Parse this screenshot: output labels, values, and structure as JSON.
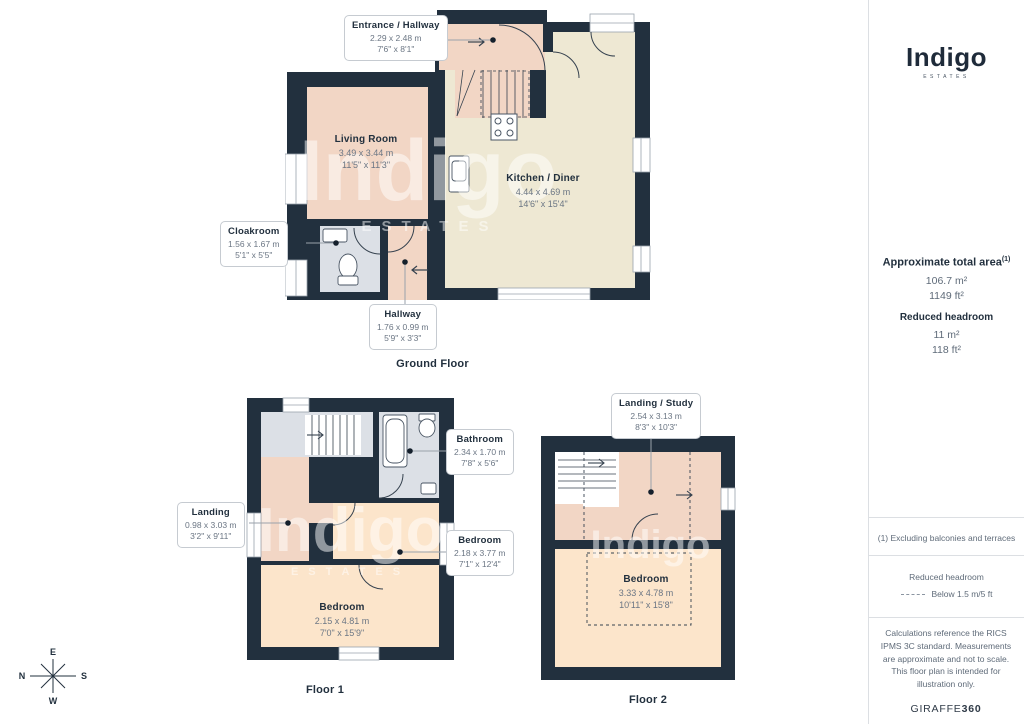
{
  "branding": {
    "logo": "Indigo",
    "logo_sub": "ESTATES",
    "giraffe_prefix": "GIRAFFE",
    "giraffe_suffix": "360"
  },
  "watermark": {
    "text": "Indigo",
    "sub": "ESTATES"
  },
  "sidebar": {
    "total_area": {
      "label": "Approximate total area",
      "sup": "(1)",
      "metric": "106.7 m²",
      "imperial": "1149 ft²"
    },
    "reduced_headroom": {
      "label": "Reduced headroom",
      "metric": "11 m²",
      "imperial": "118 ft²"
    },
    "footnote": "(1) Excluding balconies and terraces",
    "legend": {
      "label": "Reduced headroom",
      "value": "Below 1.5 m/5 ft"
    },
    "disclaimer": "Calculations reference the RICS IPMS 3C standard. Measurements are approximate and not to scale. This floor plan is intended for illustration only."
  },
  "floors": {
    "ground": "Ground Floor",
    "first": "Floor 1",
    "second": "Floor 2"
  },
  "compass": {
    "n": "N",
    "e": "E",
    "s": "S",
    "w": "W"
  },
  "rooms": {
    "entrance": {
      "name": "Entrance / Hallway",
      "metric": "2.29 x 2.48 m",
      "imperial": "7'6\" x 8'1\""
    },
    "living": {
      "name": "Living Room",
      "metric": "3.49 x 3.44 m",
      "imperial": "11'5\" x 11'3\""
    },
    "kitchen": {
      "name": "Kitchen / Diner",
      "metric": "4.44 x 4.69 m",
      "imperial": "14'6\" x 15'4\""
    },
    "cloakroom": {
      "name": "Cloakroom",
      "metric": "1.56 x 1.67 m",
      "imperial": "5'1\" x 5'5\""
    },
    "hallway": {
      "name": "Hallway",
      "metric": "1.76 x 0.99 m",
      "imperial": "5'9\" x 3'3\""
    },
    "bathroom": {
      "name": "Bathroom",
      "metric": "2.34 x 1.70 m",
      "imperial": "7'8\" x 5'6\""
    },
    "landing1": {
      "name": "Landing",
      "metric": "0.98 x 3.03 m",
      "imperial": "3'2\" x 9'11\""
    },
    "bedroom1": {
      "name": "Bedroom",
      "metric": "2.18 x 3.77 m",
      "imperial": "7'1\" x 12'4\""
    },
    "bedroom2": {
      "name": "Bedroom",
      "metric": "2.15 x 4.81 m",
      "imperial": "7'0\" x 15'9\""
    },
    "landing2": {
      "name": "Landing / Study",
      "metric": "2.54 x 3.13 m",
      "imperial": "8'3\" x 10'3\""
    },
    "bedroom3": {
      "name": "Bedroom",
      "metric": "3.33 x 4.78 m",
      "imperial": "10'11\" x 15'8\""
    }
  },
  "colors": {
    "wall": "#22303e",
    "pink": "#f2d6c5",
    "cream": "#eee8d3",
    "peach": "#fce5cb",
    "gray_room": "#dce0e6",
    "navy_text": "#22303e"
  }
}
